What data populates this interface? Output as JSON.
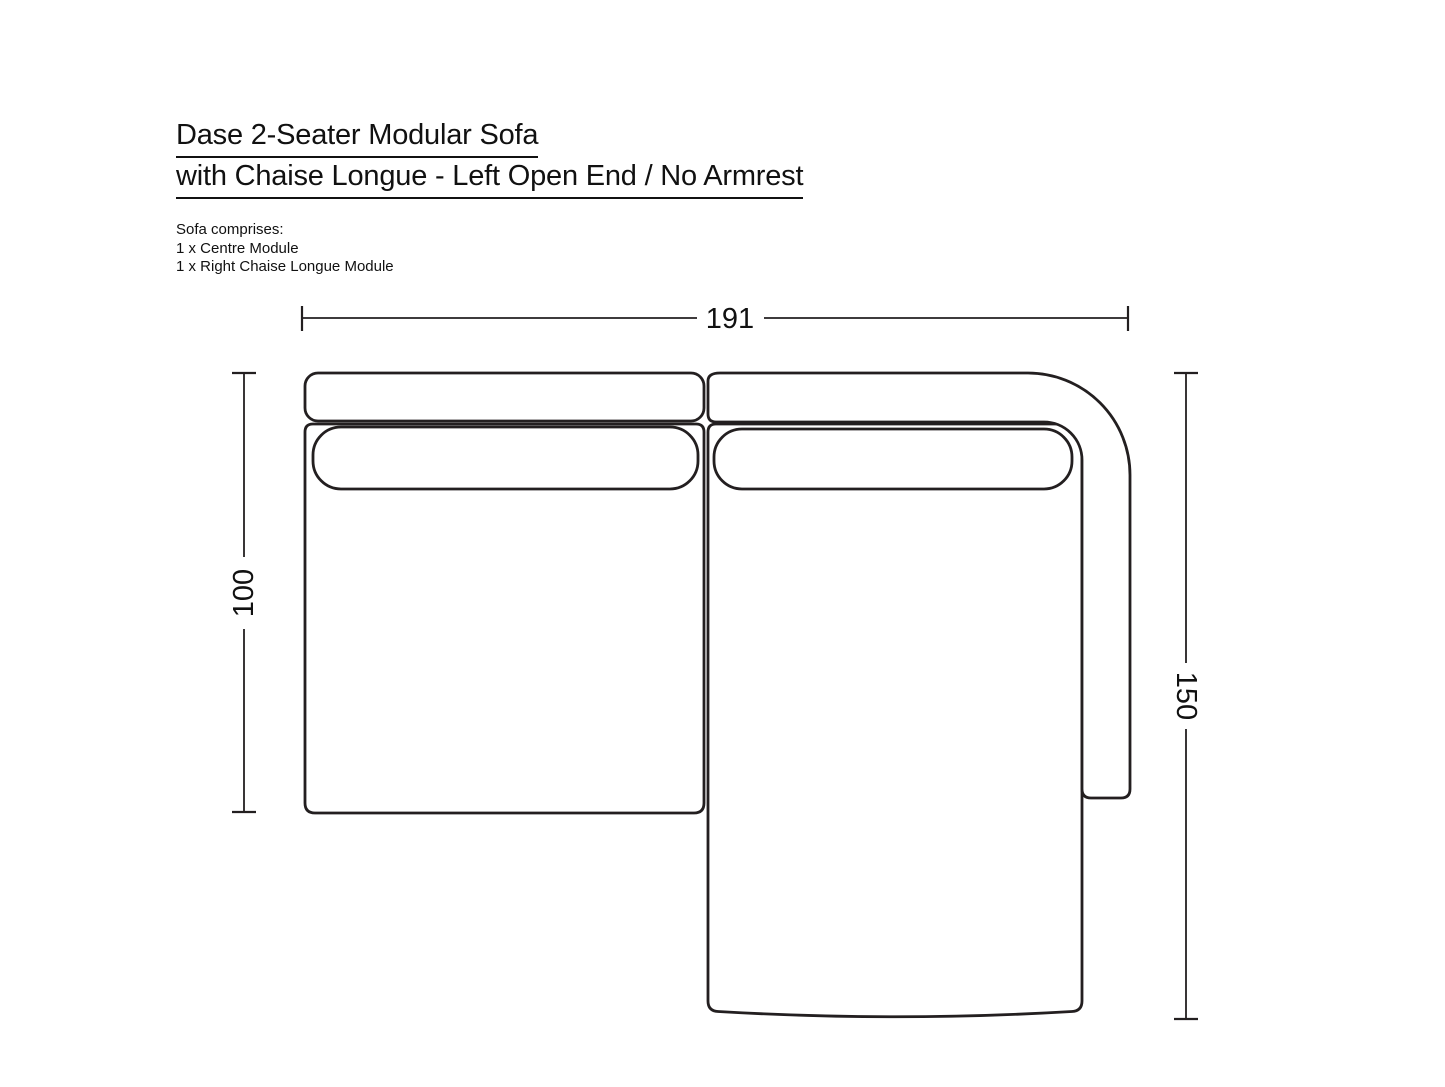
{
  "header": {
    "title_line1": "Dase 2-Seater Modular Sofa",
    "title_line2": "with Chaise Longue - Left Open End / No Armrest",
    "comprises_heading": "Sofa comprises:",
    "comprises_items": [
      "1 x Centre Module",
      "1 x Right Chaise Longue Module"
    ]
  },
  "diagram": {
    "type": "top-view-dimension-drawing",
    "dimensions": {
      "overall_width": "191",
      "centre_module_depth": "100",
      "chaise_module_depth": "150"
    },
    "colors": {
      "line": "#231f20",
      "text": "#111111",
      "background": "#ffffff"
    }
  }
}
